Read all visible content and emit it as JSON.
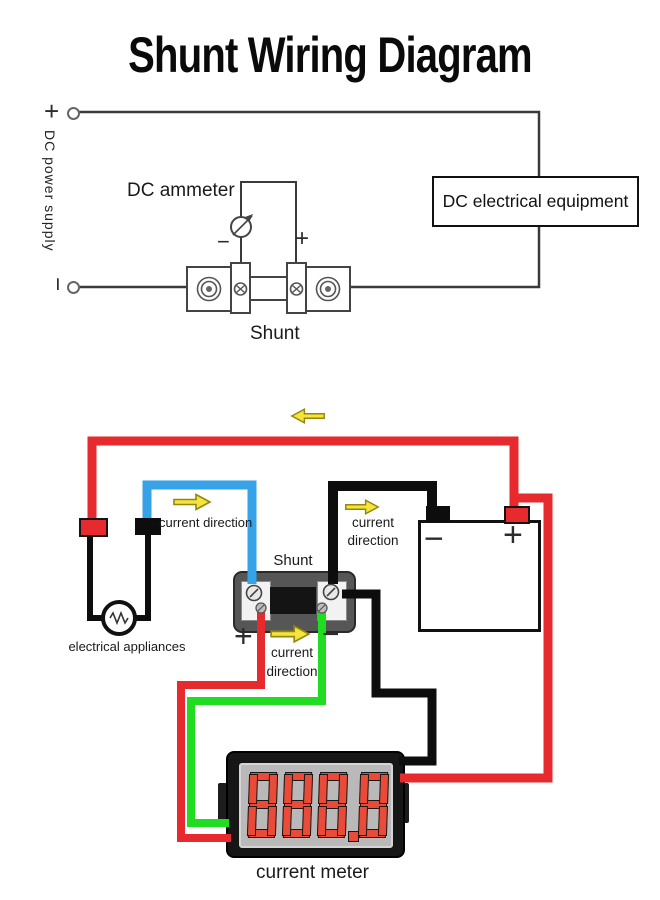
{
  "title": "Shunt Wiring Diagram",
  "top_diagram": {
    "power_supply_label": "DC power supply",
    "power_plus": "+",
    "power_minus": "−",
    "ammeter_label": "DC ammeter",
    "ammeter_minus": "−",
    "ammeter_plus": "+",
    "shunt_label": "Shunt",
    "equipment_label": "DC electrical equipment"
  },
  "bottom_diagram": {
    "current_direction_top": "current direction",
    "current_direction_battery_line1": "current",
    "current_direction_battery_line2": "direction",
    "current_direction_shunt_line1": "current",
    "current_direction_shunt_line2": "direction",
    "shunt_label": "Shunt",
    "shunt_plus": "+",
    "shunt_minus": "−",
    "battery_minus": "−",
    "battery_plus": "+",
    "appliances_label": "electrical appliances",
    "meter_label": "current meter",
    "meter_reading": "888.8"
  },
  "colors": {
    "wire-red": "#e62a2e",
    "wire-blue": "#36a2e8",
    "wire-green": "#21dd21",
    "wire-black": "#0d0d0d",
    "arrow-yellow": "#f2e53d",
    "arrow-outline": "#98860a",
    "digit-red": "#ea4a38",
    "display-gray": "#b9b9b9",
    "line-dark": "#3a3a3a"
  }
}
